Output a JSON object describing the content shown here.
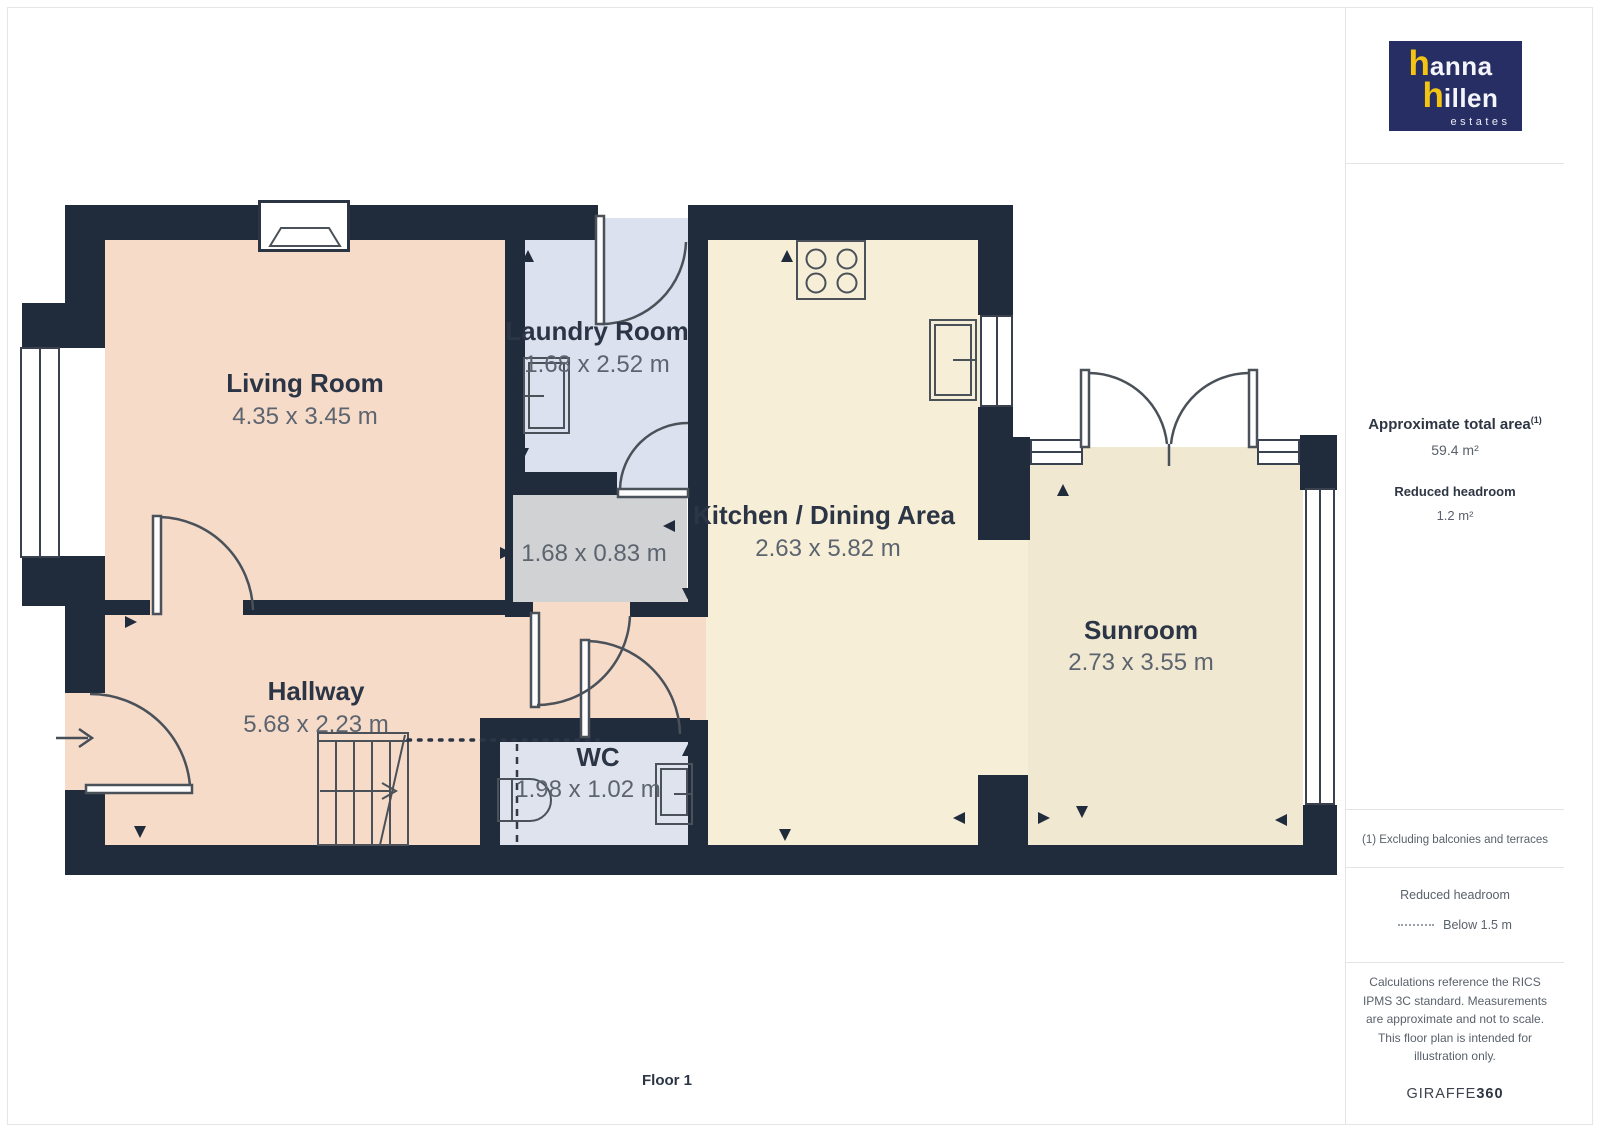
{
  "logo": {
    "line1_h": "h",
    "line1_rest": "anna",
    "line2_h": "h",
    "line2_rest": "illen",
    "line3": "estates"
  },
  "sidebar": {
    "total_area_label": "Approximate total area",
    "total_area_sup": "(1)",
    "total_area_value": "59.4 m²",
    "reduced_headroom_label": "Reduced headroom",
    "reduced_headroom_value": "1.2 m²",
    "footnote": "(1) Excluding balconies and terraces",
    "legend_title": "Reduced headroom",
    "legend_value": "Below 1.5 m",
    "disclaimer": "Calculations reference the RICS IPMS 3C standard. Measurements are approximate and not to scale. This floor plan is intended for illustration only.",
    "brand_name": "GIRAFFE",
    "brand_suffix": "360"
  },
  "floor_label": "Floor 1",
  "rooms": {
    "living": {
      "name": "Living Room",
      "dims": "4.35 x 3.45 m"
    },
    "laundry": {
      "name": "Laundry Room",
      "dims": "1.68 x 2.52 m"
    },
    "kitchen": {
      "name": "Kitchen / Dining Area",
      "dims": "2.63 x 5.82 m"
    },
    "sunroom": {
      "name": "Sunroom",
      "dims": "2.73 x 3.55 m"
    },
    "hallway": {
      "name": "Hallway",
      "dims": "5.68 x 2.23 m"
    },
    "wc": {
      "name": "WC",
      "dims": "1.98 x 1.02 m"
    },
    "store": {
      "dims": "1.68 x 0.83 m"
    }
  },
  "colors": {
    "wall": "#202b3b",
    "living_fill": "#f6dbc9",
    "laundry_fill": "#dce1ef",
    "kitchen_fill": "#f6eed7",
    "sunroom_fill": "#f0e8d1",
    "wc_fill": "#dfe3ed",
    "store_fill": "#d1d2d3",
    "brand_navy": "#272e63",
    "brand_yellow": "#f3c512"
  }
}
